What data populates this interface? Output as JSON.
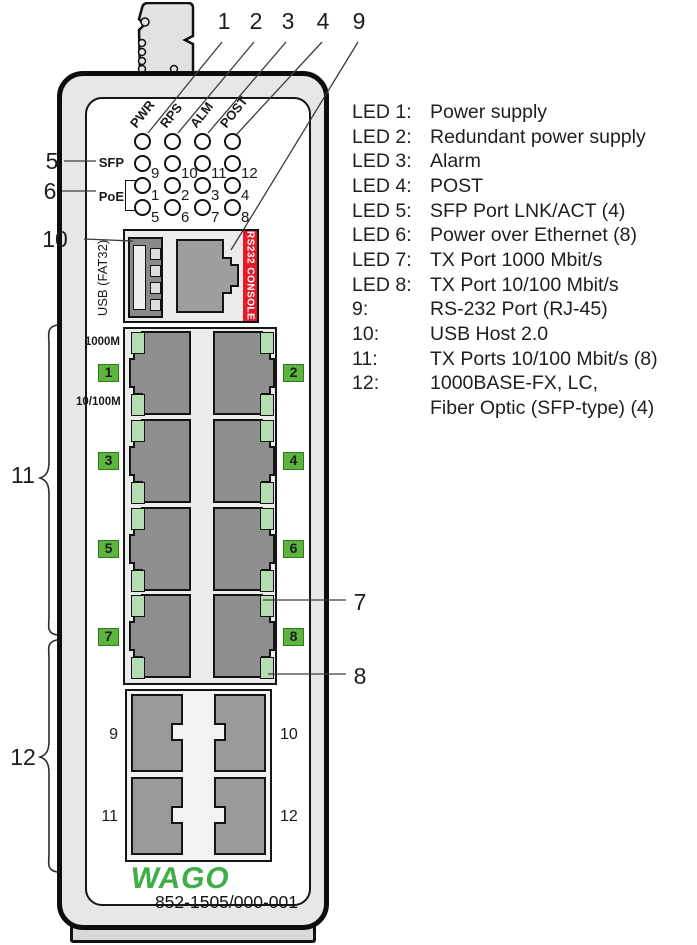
{
  "callouts": {
    "top": [
      "1",
      "2",
      "3",
      "4",
      "9"
    ],
    "left": [
      "5",
      "6",
      "10",
      "11",
      "12"
    ],
    "right": [
      "7",
      "8"
    ]
  },
  "panel": {
    "status_leds": {
      "column_labels": [
        "PWR",
        "RPS",
        "ALM",
        "POST"
      ],
      "sfp_row_numbers": [
        "9",
        "10",
        "11",
        "12"
      ],
      "poe_row1_numbers": [
        "1",
        "2",
        "3",
        "4"
      ],
      "poe_row2_numbers": [
        "5",
        "6",
        "7",
        "8"
      ],
      "sfp_label": "SFP",
      "poe_label": "PoE"
    },
    "console": {
      "usb_label": "USB (FAT32)",
      "rs232_label": "RS232 CONSOLE"
    },
    "tx_ports": {
      "speed_top_label": "1000M",
      "speed_bottom_label": "10/100M",
      "port_numbers": [
        "1",
        "2",
        "3",
        "4",
        "5",
        "6",
        "7",
        "8"
      ]
    },
    "sfp_ports": {
      "port_numbers": [
        "9",
        "10",
        "11",
        "12"
      ]
    },
    "brand": "WAGO",
    "part_number": "852-1505/000-001"
  },
  "legend": {
    "rows": [
      {
        "label": "LED 1:",
        "text": "Power supply"
      },
      {
        "label": "LED 2:",
        "text": "Redundant power supply"
      },
      {
        "label": "LED 3:",
        "text": "Alarm"
      },
      {
        "label": "LED 4:",
        "text": "POST"
      },
      {
        "label": "LED 5:",
        "text": "SFP Port LNK/ACT (4)"
      },
      {
        "label": "LED 6:",
        "text": "Power over Ethernet (8)"
      },
      {
        "label": "LED 7:",
        "text": "TX Port 1000 Mbit/s"
      },
      {
        "label": "LED 8:",
        "text": "TX Port 10/100 Mbit/s"
      },
      {
        "label": "9:",
        "text": "RS-232 Port (RJ-45)"
      },
      {
        "label": "10:",
        "text": "USB Host 2.0"
      },
      {
        "label": "11:",
        "text": "TX Ports 10/100 Mbit/s (8)"
      },
      {
        "label": "12:",
        "text": "1000BASE-FX, LC,"
      },
      {
        "label": "",
        "text": "Fiber Optic (SFP-type) (4)"
      }
    ]
  },
  "colors": {
    "port_badge_green": "#5cb53f",
    "port_led_green": "#b5dcb2",
    "console_red": "#e51a2b",
    "wago_green": "#3fae47"
  }
}
